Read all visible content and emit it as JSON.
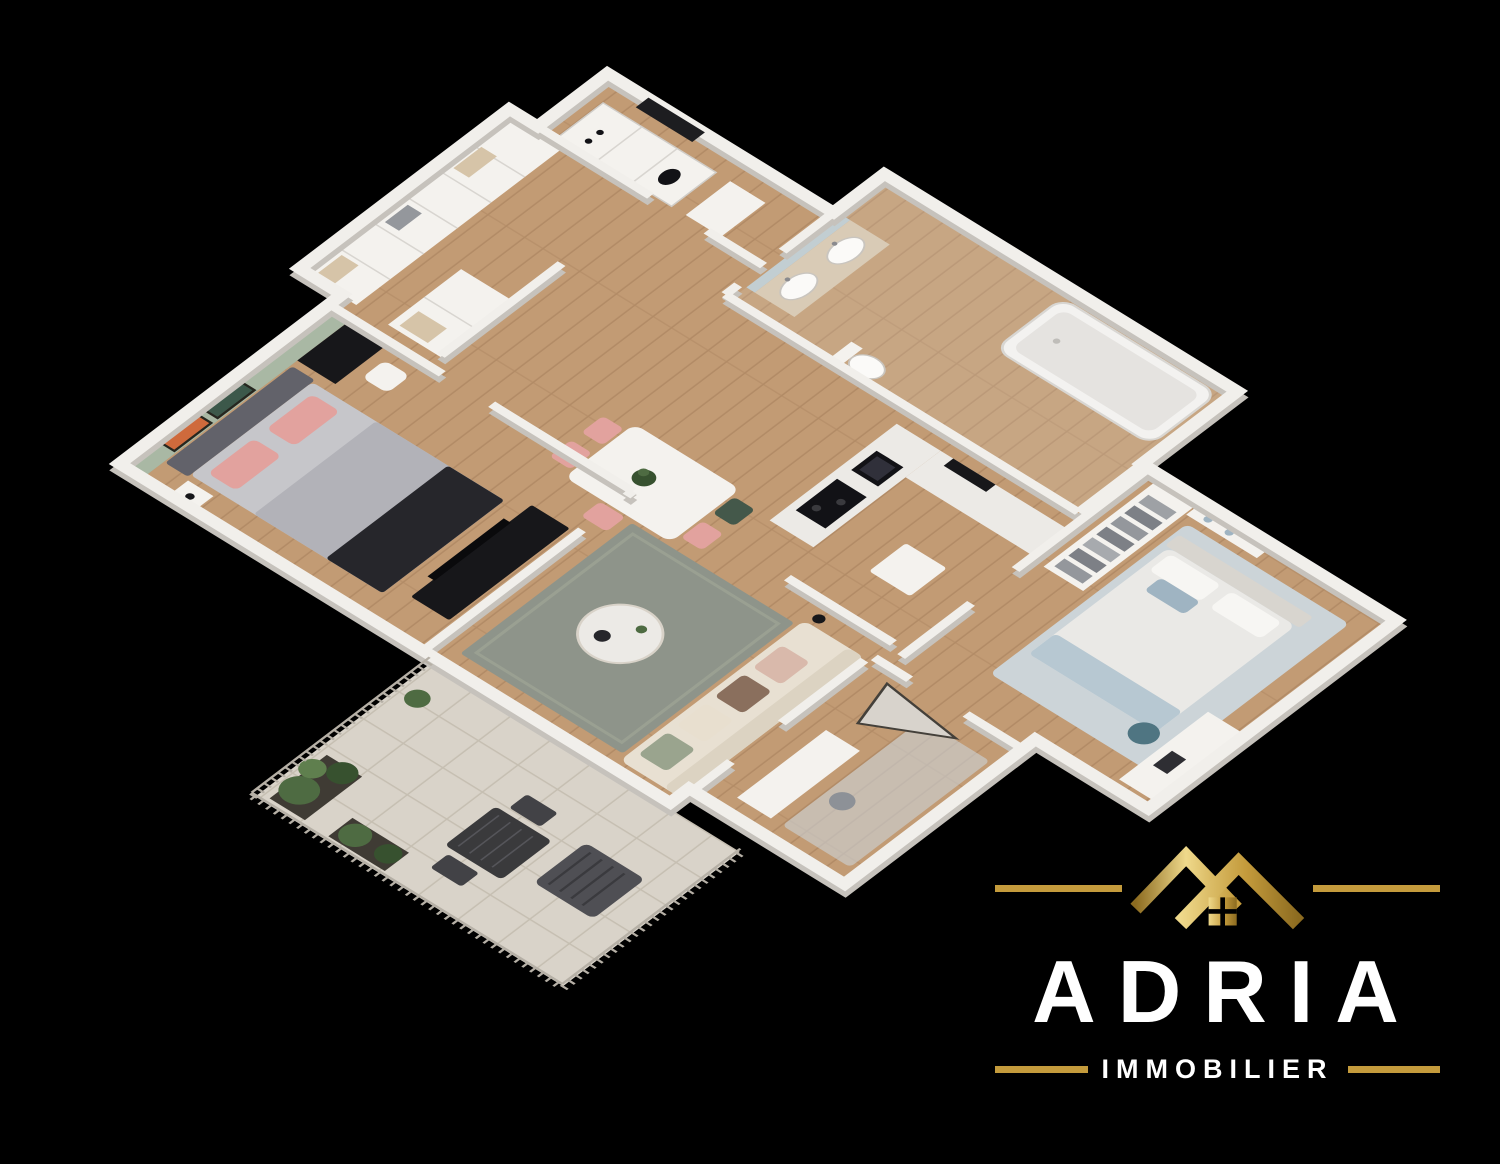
{
  "scene": {
    "description": "3D isometric architectural render of a furnished apartment floor plan on a black background",
    "background": "#000000"
  },
  "logo": {
    "brand": "ADRIA",
    "tagline": "IMMOBILIER",
    "icon": "gold-double-roof-house-icon",
    "colors": {
      "gold": "#C49B3C",
      "gold_light": "#EFD98B",
      "gold_dark": "#8C6B20",
      "text": "#FFFFFF"
    }
  },
  "floorplan": {
    "view": "isometric-top-down",
    "rooms": [
      {
        "id": "master-bedroom",
        "features": [
          "double bed with grey duvet and dark throw",
          "pink pillows",
          "sage accent wall",
          "orange and green artworks",
          "black desk with white chair",
          "nightstand with lamp",
          "black TV console"
        ]
      },
      {
        "id": "wardrobe-hall",
        "features": [
          "open white wardrobes with shelves",
          "folded clothes"
        ]
      },
      {
        "id": "entry-utility",
        "features": [
          "dark front door",
          "tall white utility unit with black controls"
        ]
      },
      {
        "id": "kitchen",
        "features": [
          "L-shaped white counter",
          "black cooktop",
          "black sink",
          "oven",
          "white island cube"
        ]
      },
      {
        "id": "dining-area",
        "features": [
          "white dining table",
          "pink chairs",
          "green chair",
          "plant centerpiece"
        ]
      },
      {
        "id": "living-room",
        "features": [
          "grey-green rug",
          "round white coffee table",
          "cream sofa with pillows",
          "floor lamp"
        ]
      },
      {
        "id": "bathroom",
        "features": [
          "mirror",
          "wood vanity with two sinks",
          "white bathtub",
          "toilet"
        ]
      },
      {
        "id": "walk-in-closet",
        "features": [
          "white shelving",
          "grey folded clothes piles"
        ]
      },
      {
        "id": "second-bedroom",
        "features": [
          "bed with white duvet and blue pillows",
          "light blue rug",
          "white desk",
          "teal chair",
          "wall shelf with blue boxes"
        ]
      },
      {
        "id": "office-nook",
        "features": [
          "white desk",
          "leaning mirror",
          "stool",
          "small rug"
        ]
      },
      {
        "id": "balcony",
        "features": [
          "tiled floor",
          "baluster railing",
          "green potted plants",
          "dark outdoor table and chairs",
          "lounge chair"
        ]
      }
    ],
    "colors": {
      "wood": "#c29b74",
      "wood_line": "#ab8560",
      "wall": "#f1efeb",
      "wall_base": "#c6c2bc",
      "seam": "#d8d5d0",
      "tile": "#d9d3c9",
      "tile_line": "#c6bfb2",
      "rail": "#b6b0a6",
      "sage": "#a9b8a4",
      "art_orange": "#cf6a3c",
      "art_green": "#3c584a",
      "headboard": "#62626a",
      "bed_gray": "#c6c6ca",
      "bed_duvet": "#b2b2b8",
      "throw_dark": "#26262b",
      "pink": "#e2a29e",
      "white_furn": "#f4f2ee",
      "black_furn": "#17171a",
      "counter": "#eceae6",
      "appliance": "#121216",
      "rug_living": "#8e948a",
      "sofa": "#e8e0d2",
      "sofa_shade": "#dcd3c2",
      "rug_bed2": "#ccd4d8",
      "duvet2": "#eae9e6",
      "pillow_blue": "#9fb4c2",
      "blanket_blue": "#b7c8d2",
      "closet_gray": "#94979c",
      "closet_gray2": "#7d8086",
      "teal": "#4f7582",
      "tub": "#f3f2f0",
      "tub_inner": "#e5e3e0",
      "vanity_wood": "#d9cbb6",
      "mirror": "#c2ced2",
      "bath_tint": "#d9cdbb",
      "plant": "#4e6b42",
      "plant_dark": "#37512f",
      "plant_light": "#5f7f4e",
      "planter": "#3f3b34",
      "outdoor_dark": "#424246",
      "glass": "#aec4cc",
      "beige_items": "#d6c4a8",
      "chair_green": "#44584a"
    }
  }
}
